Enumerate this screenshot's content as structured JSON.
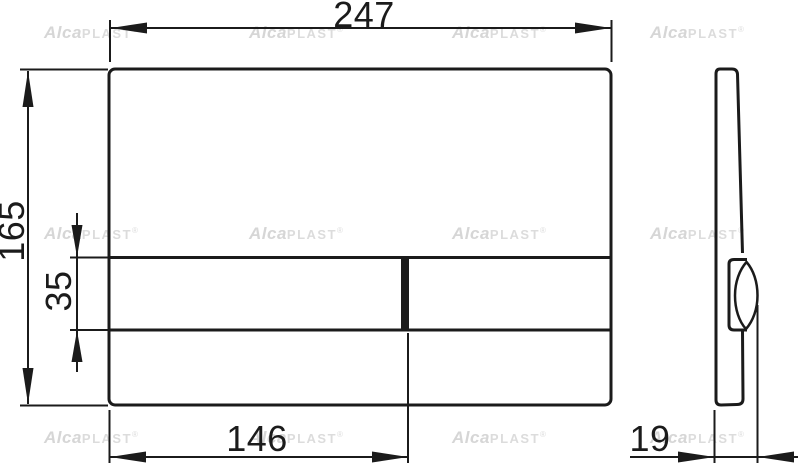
{
  "watermark": {
    "alca": "Alca",
    "plast": "PLAST",
    "reg": "®",
    "color": "#d6d6d6"
  },
  "dimensions": {
    "plate_width": {
      "value": "247"
    },
    "plate_height": {
      "value": "165"
    },
    "button_height": {
      "value": "35"
    },
    "button_width": {
      "value": "146"
    },
    "plate_depth": {
      "value": "19"
    }
  },
  "colors": {
    "line": "#1b1b1b",
    "background": "#ffffff",
    "watermark": "#d6d6d6"
  }
}
